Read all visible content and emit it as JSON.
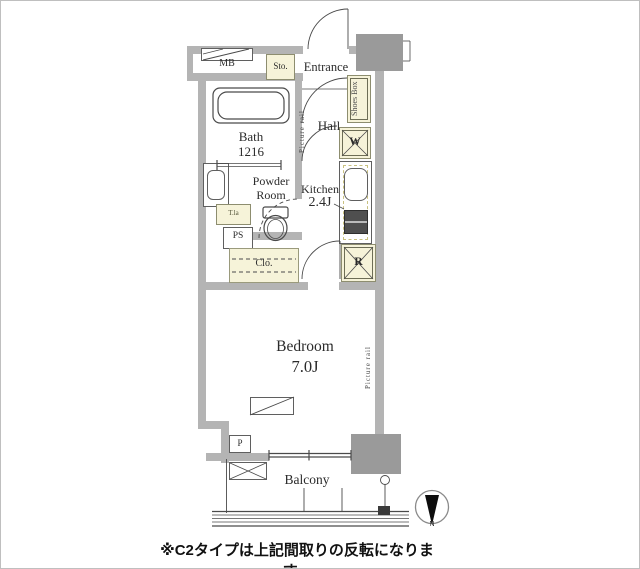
{
  "caption": {
    "text": "※С2タイプは上記間取りの反転になります。"
  },
  "compass": {
    "north": "N"
  },
  "labels": {
    "mb": "MB",
    "sto": "Sto.",
    "entrance": "Entrance",
    "shoes_box": "Shoes Box",
    "picture_rail_hall": "Picture rail",
    "picture_rail_bedroom": "Picture rail",
    "hall": "Hall",
    "bath_name": "Bath",
    "bath_size": "1216",
    "powder_line1": "Powder",
    "powder_line2": "Room",
    "kitchen_name": "Kitchen",
    "kitchen_size": "2.4J",
    "washing_machine": "W",
    "refrigerator": "R",
    "ps": "PS",
    "laundry_shelf": "T.la",
    "closet": "Clo.",
    "bedroom_name": "Bedroom",
    "bedroom_size": "7.0J",
    "pipe": "P",
    "balcony": "Balcony"
  },
  "colors": {
    "wall": "#b4b4b4",
    "pillar": "#9a9a9a",
    "fixture_fill": "#f6f3d9",
    "line": "#4a4a4a",
    "caption_text": "#111111"
  }
}
